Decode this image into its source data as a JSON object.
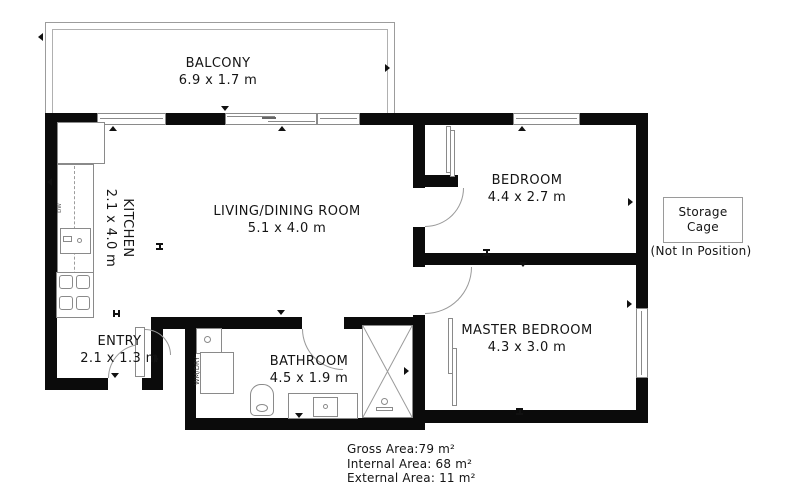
{
  "rooms": {
    "balcony": {
      "name": "BALCONY",
      "dims": "6.9 x 1.7 m"
    },
    "living": {
      "name": "LIVING/DINING ROOM",
      "dims": "5.1 x 4.0 m"
    },
    "kitchen": {
      "name": "KITCHEN",
      "dims": "2.1 x 4.0 m"
    },
    "entry": {
      "name": "ENTRY",
      "dims": "2.1 x 1.3 m"
    },
    "bathroom": {
      "name": "BATHROOM",
      "dims": "4.5 x 1.9 m"
    },
    "bedroom": {
      "name": "BEDROOM",
      "dims": "4.4 x 2.7 m"
    },
    "master": {
      "name": "MASTER BEDROOM",
      "dims": "4.3 x 3.0 m"
    }
  },
  "storage": {
    "title_line1": "Storage",
    "title_line2": "Cage",
    "note": "(Not In Position)"
  },
  "areas": {
    "gross": "Gross Area:79 m²",
    "internal": "Internal Area: 68 m²",
    "external": "External Area: 11 m²"
  },
  "fixtures": {
    "laundry": "WM/DRY",
    "dishwasher": "DW"
  },
  "colors": {
    "wall": "#0b0b0b",
    "fixture_line": "#8a8a8a",
    "text": "#141414"
  }
}
